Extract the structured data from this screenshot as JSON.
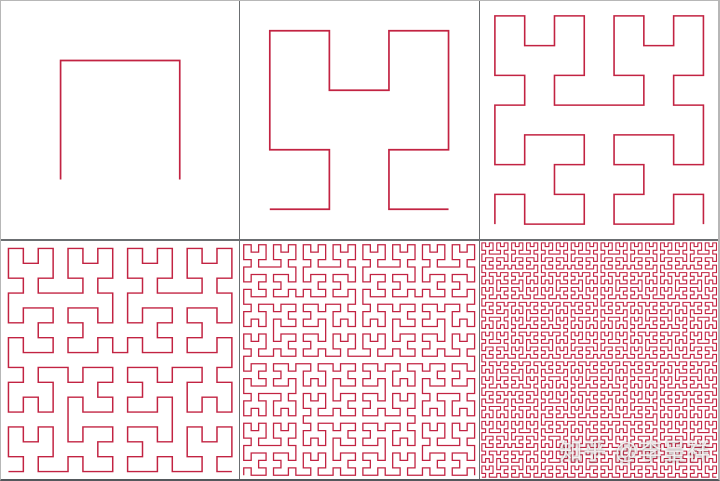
{
  "figure": {
    "curve_color": "#c22342",
    "panel_background": "#ffffff",
    "divider_color": "#6b6e71",
    "outer_border_light": "#b7b7b7",
    "outer_border_dark": "#54585c",
    "panels": [
      {
        "order": 1,
        "stroke_width": 1.7
      },
      {
        "order": 2,
        "stroke_width": 1.7
      },
      {
        "order": 3,
        "stroke_width": 1.6
      },
      {
        "order": 4,
        "stroke_width": 1.5
      },
      {
        "order": 5,
        "stroke_width": 1.3
      },
      {
        "order": 6,
        "stroke_width": 1.1
      }
    ],
    "watermark": {
      "text": "知乎 @李呈祥",
      "color": "rgba(255,255,255,0.85)"
    }
  }
}
